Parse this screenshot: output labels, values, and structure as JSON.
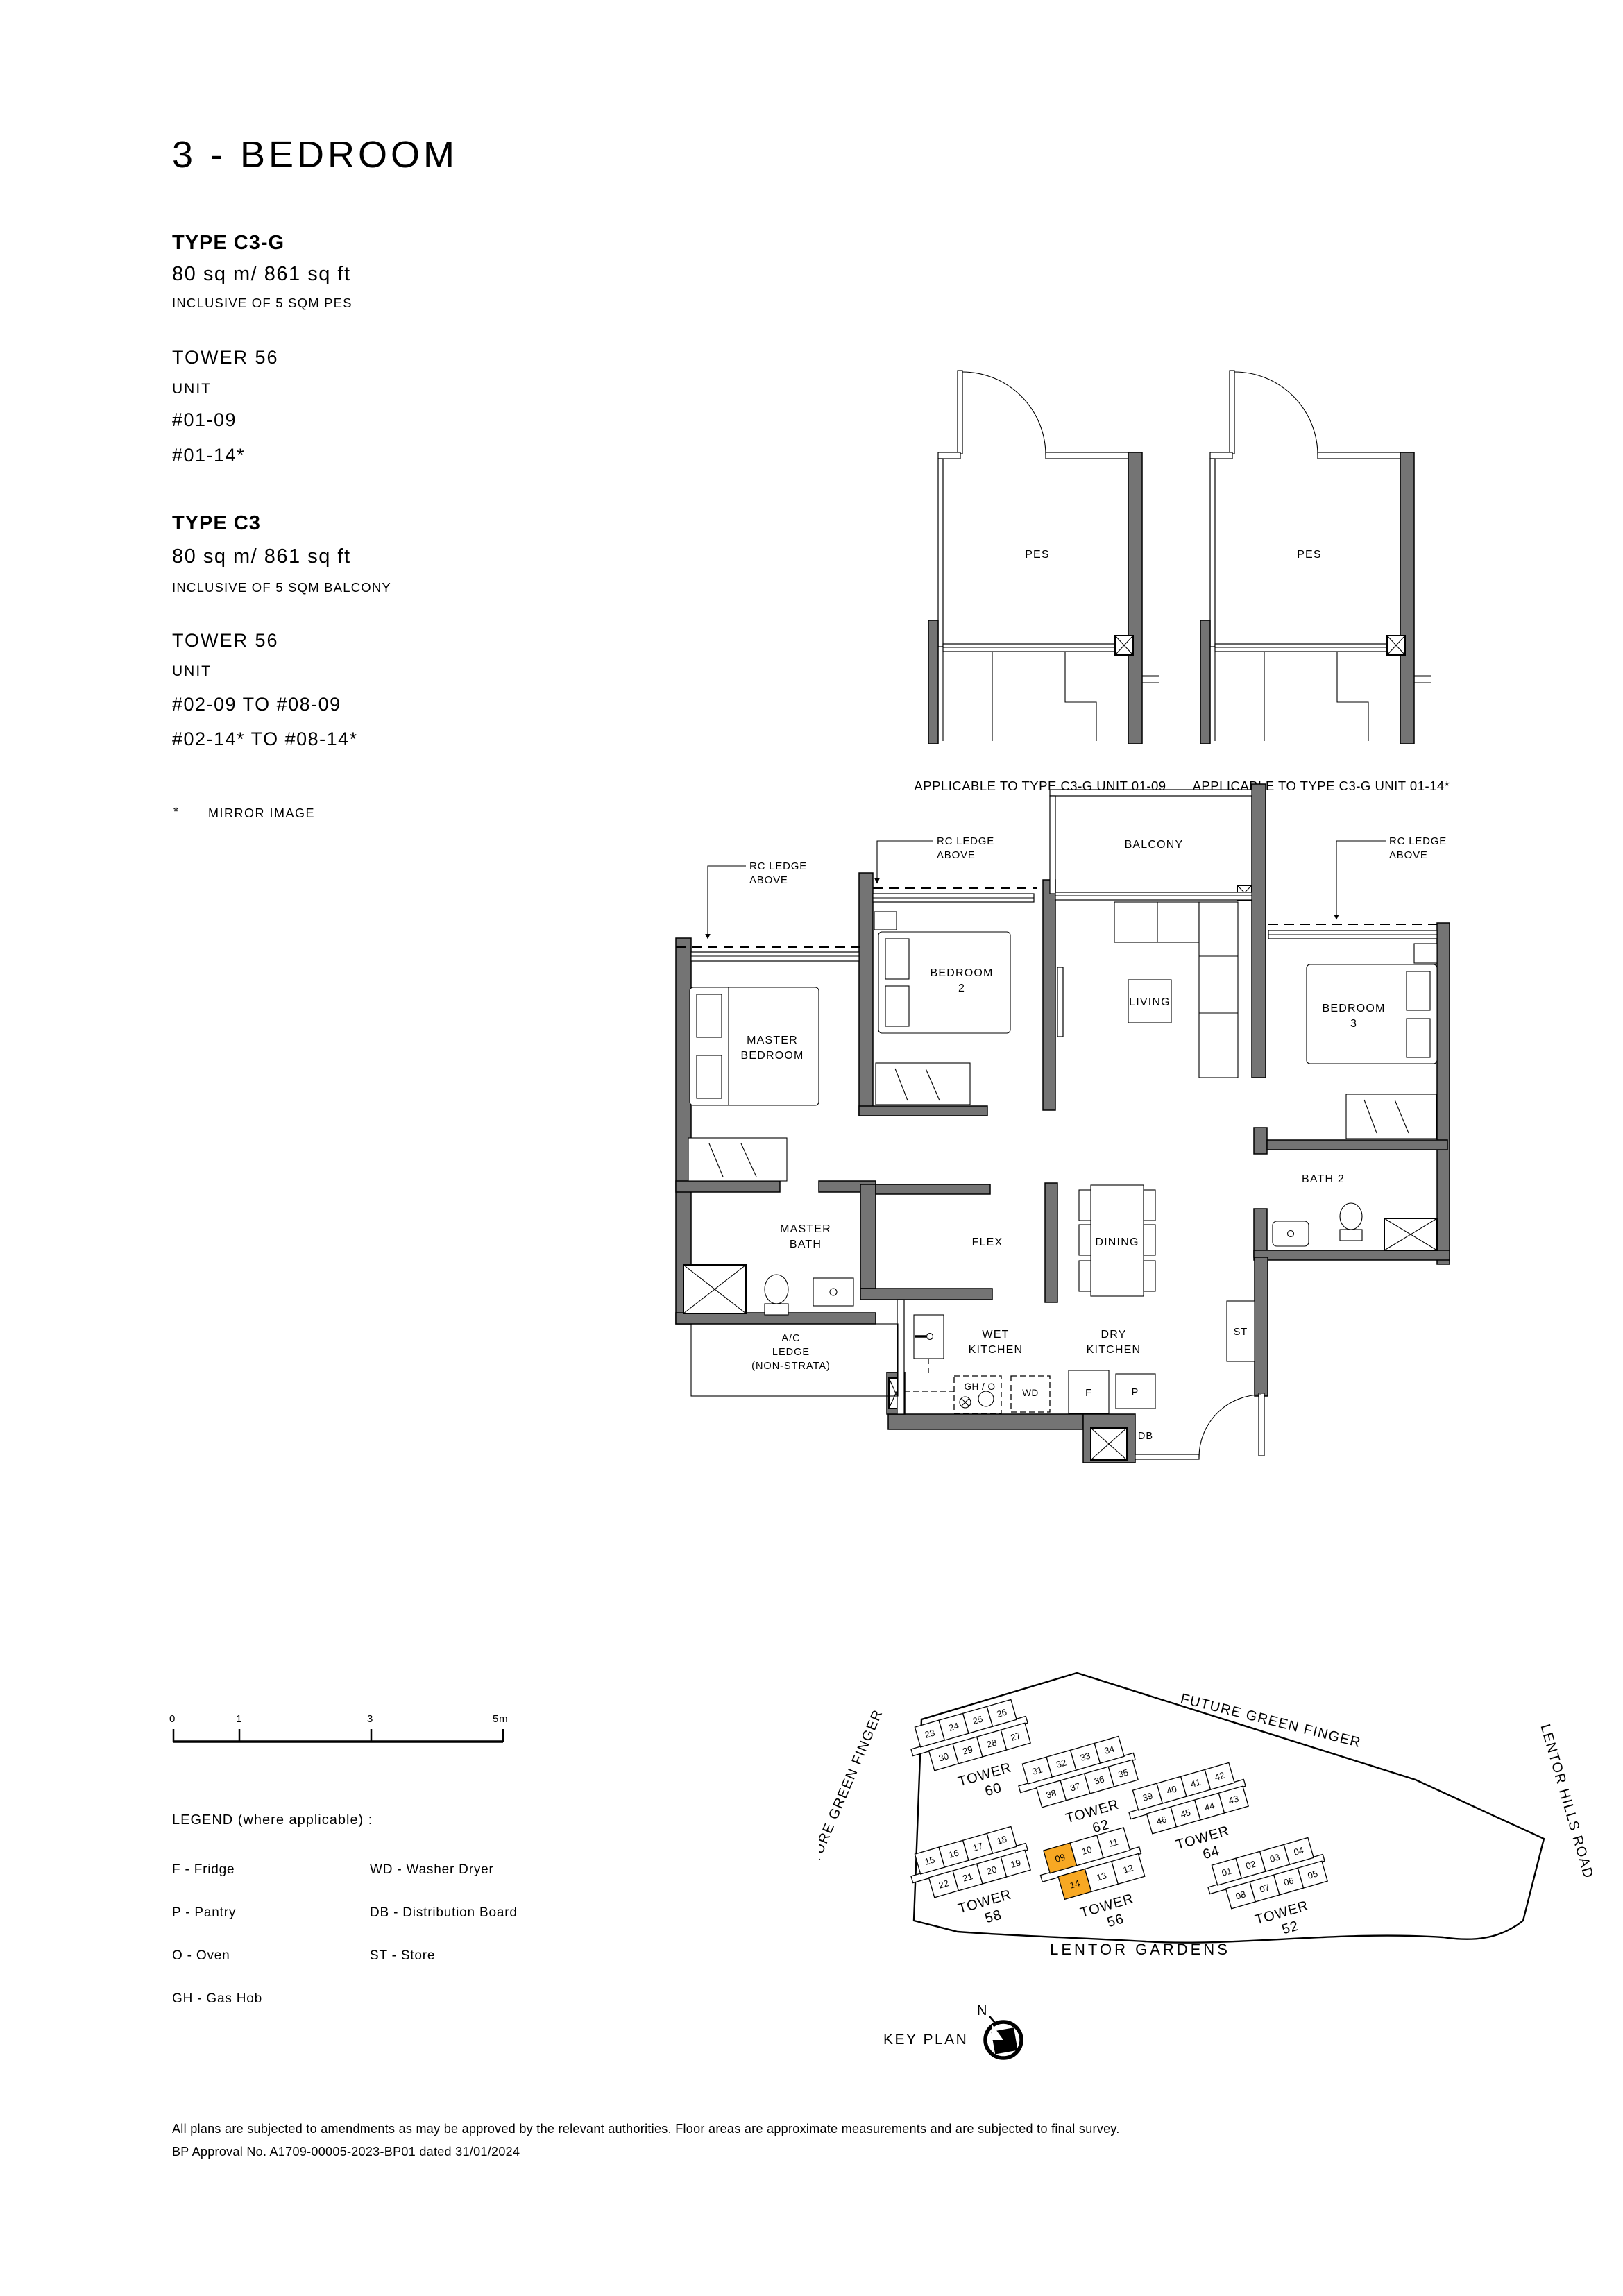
{
  "page": {
    "title": "3 - BEDROOM"
  },
  "types": [
    {
      "name": "TYPE C3-G",
      "area": "80 sq m/ 861 sq ft",
      "note": "INCLUSIVE OF 5 SQM PES",
      "tower": "TOWER 56",
      "unit_label": "UNIT",
      "units": [
        "#01-09",
        "#01-14*"
      ]
    },
    {
      "name": "TYPE C3",
      "area": "80 sq m/ 861 sq ft",
      "note": "INCLUSIVE OF 5 SQM BALCONY",
      "tower": "TOWER 56",
      "unit_label": "UNIT",
      "units": [
        "#02-09 TO #08-09",
        "#02-14* TO #08-14*"
      ]
    }
  ],
  "footnote": {
    "symbol": "*",
    "text": "MIRROR IMAGE"
  },
  "mini_plans": [
    {
      "room": "PES",
      "caption": "APPLICABLE TO TYPE C3-G UNIT 01-09"
    },
    {
      "room": "PES",
      "caption": "APPLICABLE TO TYPE C3-G UNIT 01-14*"
    }
  ],
  "floor_plan": {
    "annotations": {
      "rc_ledge": [
        "RC LEDGE",
        "ABOVE"
      ]
    },
    "rooms": {
      "balcony": "BALCONY",
      "living": "LIVING",
      "dining": "DINING",
      "flex": "FLEX",
      "bath2": "BATH 2",
      "st": "ST",
      "master_bedroom": [
        "MASTER",
        "BEDROOM"
      ],
      "bedroom2": [
        "BEDROOM",
        "2"
      ],
      "bedroom3": [
        "BEDROOM",
        "3"
      ],
      "master_bath": [
        "MASTER",
        "BATH"
      ],
      "wet_kitchen": [
        "WET",
        "KITCHEN"
      ],
      "dry_kitchen": [
        "DRY",
        "KITCHEN"
      ],
      "ac_ledge": [
        "A/C",
        "LEDGE",
        "(NON-STRATA)"
      ]
    },
    "appliances": {
      "gh_o": "GH / O",
      "wd": "WD",
      "f": "F",
      "p": "P",
      "db": "DB"
    }
  },
  "scale_bar": {
    "labels": [
      "0",
      "1",
      "3",
      "5m"
    ]
  },
  "legend": {
    "title": "LEGEND (where applicable) :",
    "columns": [
      [
        "F - Fridge",
        "P - Pantry",
        "O - Oven",
        "GH - Gas Hob"
      ],
      [
        "WD - Washer Dryer",
        "DB - Distribution Board",
        "ST - Store"
      ]
    ]
  },
  "key_plan": {
    "label": "KEY PLAN",
    "north": "N",
    "roads": {
      "top": "FUTURE GREEN FINGER",
      "left": "FUTURE GREEN FINGER",
      "right": "LENTOR HILLS ROAD",
      "bottom": "LENTOR GARDENS"
    },
    "highlight_color": "#F7A823",
    "towers": [
      {
        "label": "TOWER",
        "number": "60",
        "row1": [
          "23",
          "24",
          "25",
          "26"
        ],
        "row2": [
          "30",
          "29",
          "28",
          "27"
        ],
        "highlight": []
      },
      {
        "label": "TOWER",
        "number": "62",
        "row1": [
          "31",
          "32",
          "33",
          "34"
        ],
        "row2": [
          "38",
          "37",
          "36",
          "35"
        ],
        "highlight": []
      },
      {
        "label": "TOWER",
        "number": "64",
        "row1": [
          "39",
          "40",
          "41",
          "42"
        ],
        "row2": [
          "46",
          "45",
          "44",
          "43"
        ],
        "highlight": []
      },
      {
        "label": "TOWER",
        "number": "58",
        "row1": [
          "15",
          "16",
          "17",
          "18"
        ],
        "row2": [
          "22",
          "21",
          "20",
          "19"
        ],
        "highlight": []
      },
      {
        "label": "TOWER",
        "number": "56",
        "row1": [
          "09",
          "10",
          "11"
        ],
        "row2": [
          "14",
          "13",
          "12"
        ],
        "highlight": [
          "09",
          "14"
        ]
      },
      {
        "label": "TOWER",
        "number": "52",
        "row1": [
          "01",
          "02",
          "03",
          "04"
        ],
        "row2": [
          "08",
          "07",
          "06",
          "05"
        ],
        "highlight": []
      }
    ]
  },
  "disclaimer": [
    "All plans are subjected to amendments as may be approved by the relevant authorities. Floor areas are approximate measurements and are subjected to final survey.",
    "BP Approval No. A1709-00005-2023-BP01 dated 31/01/2024"
  ],
  "colors": {
    "wall": "#747474",
    "line": "#000000",
    "highlight": "#F7A823"
  }
}
